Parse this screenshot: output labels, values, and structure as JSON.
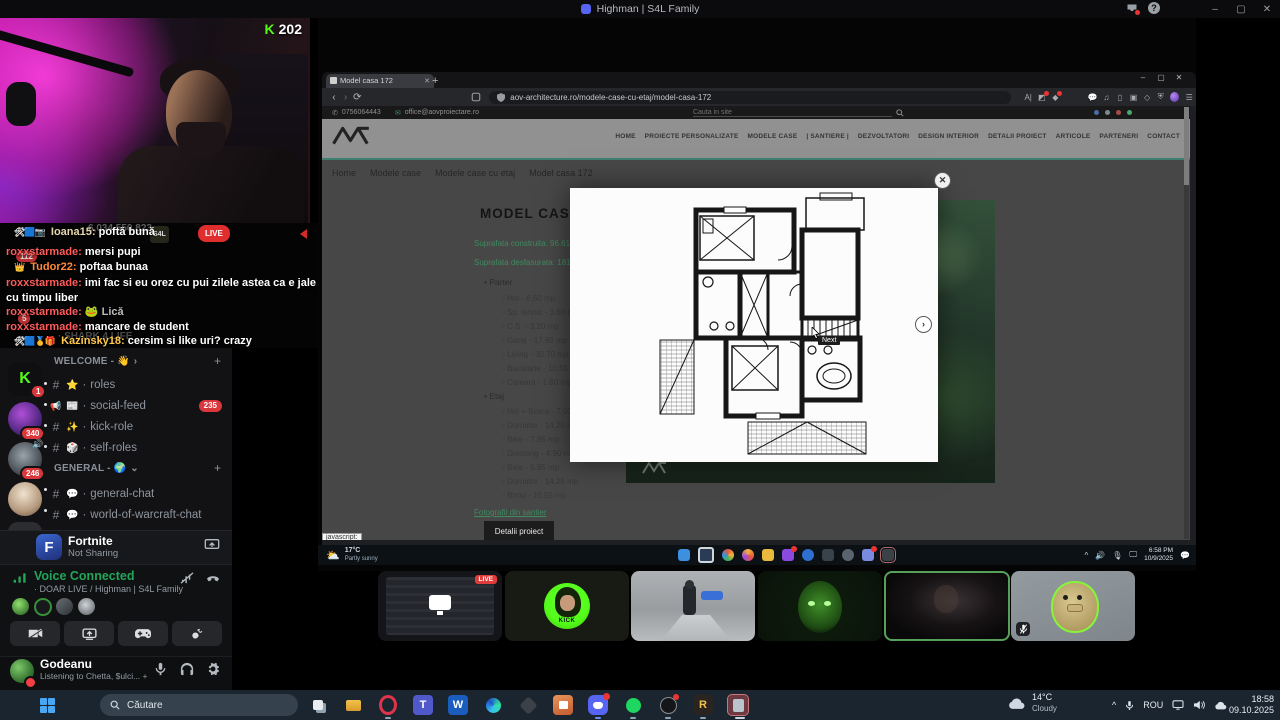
{
  "window": {
    "title": "Highman | S4L Family",
    "min": "–",
    "max": "▢",
    "close": "✕"
  },
  "stream": {
    "platform_letter": "K",
    "viewers": "202",
    "live": "LIVE",
    "coin_counter": "6,034,550,823",
    "coin_badge": "S4L"
  },
  "chat": {
    "faint": "· SHARK 4 LIFE",
    "messages": [
      {
        "badges": "🛠🟦📷",
        "user": "Ioana15:",
        "text": "poftă bună"
      },
      {
        "badges": "",
        "user": "roxxstarmade:",
        "text": "mersi pupi"
      },
      {
        "badges": "👑",
        "user": "Tudor22:",
        "text": "poftaa bunaa"
      },
      {
        "badges": "",
        "user": "roxxstarmade:",
        "text": "imi fac si eu orez cu pui zilele astea ca e jale cu timpu liber"
      },
      {
        "badges": "",
        "user": "roxxstarmade:",
        "emote": "🐸",
        "text": "Lică"
      },
      {
        "badges": "",
        "user": "roxxstarmade:",
        "text": "mancare de student"
      },
      {
        "badges": "🛠🟦🥇🎁",
        "user": "Kazinsky18:",
        "text": "cersim si like uri? crazy"
      }
    ]
  },
  "rail": {
    "kick_letter": "K",
    "kick_badge": "1",
    "badge_112": "112",
    "badge_5": "5",
    "badge_340": "340",
    "badge_246": "246",
    "new_label": "NEW"
  },
  "channels": {
    "cat1": "WELCOME - 👋",
    "chev1": "›",
    "cat2": "GENERAL - 🌍",
    "chev2": "⌄",
    "add": "+",
    "sep": "·",
    "items": [
      {
        "type": "#",
        "emoji": "⭐",
        "name": "roles"
      },
      {
        "type": "📢",
        "emoji": "📰",
        "name": "social-feed",
        "badge": "235"
      },
      {
        "type": "#",
        "emoji": "✨",
        "name": "kick-role"
      },
      {
        "type": "#",
        "emoji": "🎲",
        "name": "self-roles"
      },
      {
        "type": "#",
        "emoji": "💬",
        "name": "general-chat"
      },
      {
        "type": "#",
        "emoji": "💬",
        "name": "world-of-warcraft-chat"
      }
    ]
  },
  "activity": {
    "icon_letter": "F",
    "name": "Fortnite",
    "status": "Not Sharing"
  },
  "voice": {
    "status": "Voice Connected",
    "channel": "· DOAR LIVE / Highman | S4L Family"
  },
  "user": {
    "name": "Godeanu",
    "activity": "Listening to Chetta, $ulci... +1"
  },
  "browser": {
    "tab": "Model casa 172",
    "newtab": "+",
    "back": "‹",
    "forward": "›",
    "reload": "⟳",
    "url": "aov-architecture.ro/modele-case-cu-etaj/model-casa-172",
    "menu": "☰",
    "status_tooltip": "javascript:",
    "min": "–",
    "max": "▢",
    "close": "✕",
    "tabclose": "✕"
  },
  "site": {
    "phone": "0756064443",
    "email": "office@aovproiectare.ro",
    "search": "Cauta in site",
    "nav": [
      "HOME",
      "PROIECTE PERSONALIZATE",
      "MODELE CASE",
      "| SANTIERE |",
      "DEZVOLTATORI",
      "DESIGN INTERIOR",
      "DETALII PROIECT",
      "ARTICOLE",
      "PARTENERI",
      "CONTACT"
    ],
    "breadcrumb": [
      "Home",
      "Modele case",
      "Modele case cu etaj",
      "Model casa 172"
    ],
    "title": "MODEL CASA 172",
    "area_built": "Suprafata construita: 96.61 mp",
    "area_total": "Suprafata desfasurata: 181.7 mp",
    "floor1_label": "Parter",
    "floor1": [
      "Hol - 6.50 mp",
      "Sp. tehnic - 3.60 mp",
      "C.S. - 3.20 mp",
      "Garaj - 17.60 mp",
      "Living - 30.70 mp",
      "Bucatarie - 10.55 mp",
      "Camara - 1.80 mp"
    ],
    "floor2_label": "Etaj",
    "floor2": [
      "Hol + Scara - 7.00 mp",
      "Dormitor - 14.20 mp",
      "Baie - 7.85 mp",
      "Dressing - 4.90 mp",
      "Baie - 5.85 mp",
      "Dormitor - 14.25 mp",
      "Birou - 10.55 mp"
    ],
    "photos_link": "Fotografii din santier",
    "details_button": "Detalii proiect",
    "modal_close": "✕",
    "modal_next": "›",
    "modal_tooltip": "Next"
  },
  "shared_taskbar": {
    "temp": "17°C",
    "condition": "Partly sunny",
    "chevron": "^",
    "time": "6:58 PM",
    "date": "10/9/2025"
  },
  "tiles": {
    "live": "LIVE",
    "kick": "KICK"
  },
  "taskbar": {
    "search": "Căutare",
    "chevron": "^",
    "lang": "ROU",
    "temp": "14°C",
    "condition": "Cloudy",
    "time": "18:58",
    "date": "09.10.2025",
    "letters": {
      "teams": "T",
      "word": "W",
      "reaper": "R"
    }
  },
  "colors": {
    "kick_green": "#53fc18",
    "voice_green": "#23a55a",
    "live_red": "#e02e2e",
    "link_green": "#3f8a5f",
    "badge_red": "#da373c"
  }
}
